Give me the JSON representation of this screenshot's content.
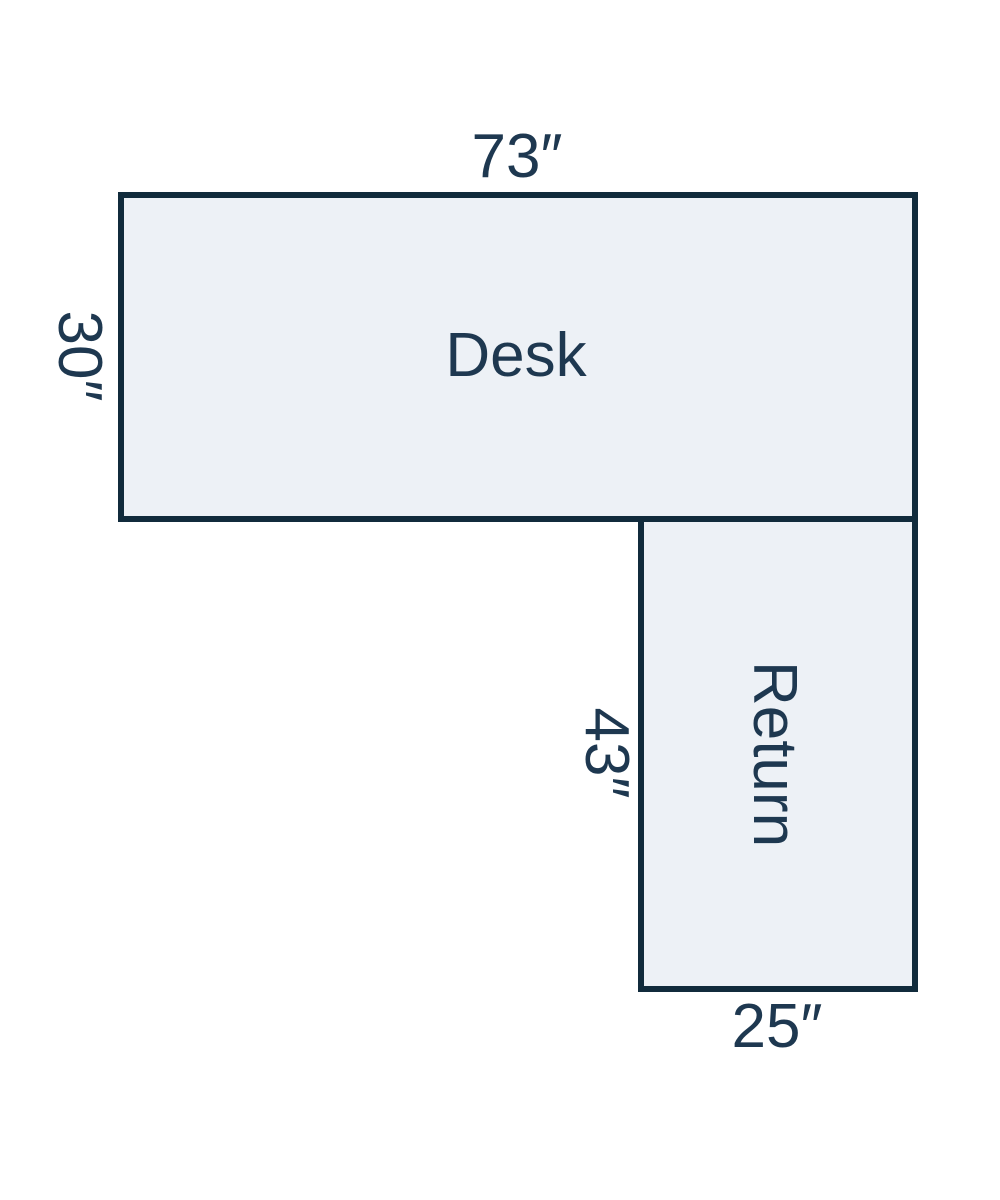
{
  "diagram": {
    "type": "furniture-dimension-diagram",
    "units": "inches"
  },
  "desk": {
    "label": "Desk",
    "width_in": 73,
    "depth_in": 30,
    "width_label": "73″",
    "depth_label": "30″"
  },
  "return": {
    "label": "Return",
    "length_in": 43,
    "width_in": 25,
    "length_label": "43″",
    "width_label": "25″"
  },
  "colors": {
    "background": "#ffffff",
    "fill": "#edf1f6",
    "stroke": "#112b3c",
    "text": "#1e3850"
  }
}
